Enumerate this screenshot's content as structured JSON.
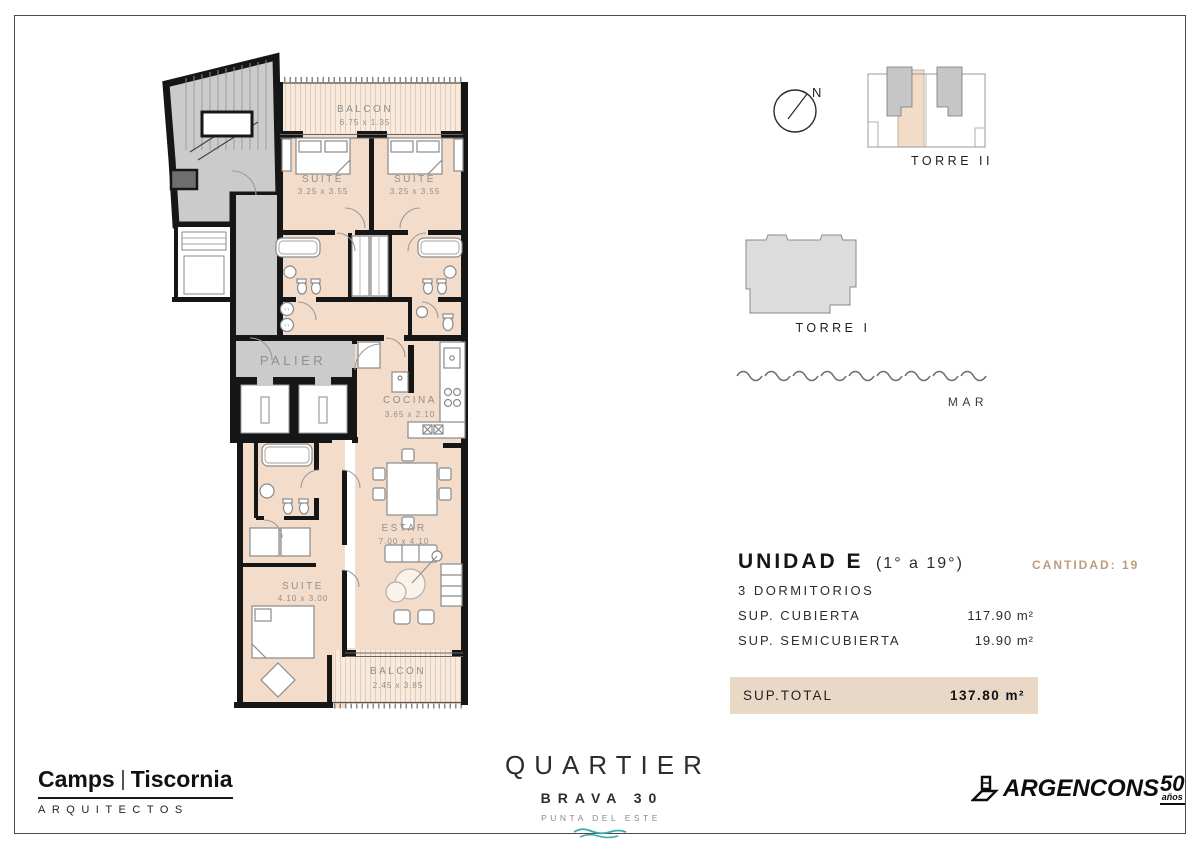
{
  "colors": {
    "accent_tan": "#bf9c79",
    "total_bar_bg": "#e9d8c6",
    "brand_teal": "#3aaca4",
    "room_beige": "#f3dcc9",
    "balcony_beige": "#f8ebdd",
    "common_gray": "#cbcbcb",
    "wall_black": "#161616"
  },
  "plan": {
    "balcon_top": {
      "name": "BALCON",
      "dims": "6.75 x 1.35"
    },
    "suite_1": {
      "name": "SUITE",
      "dims": "3.25 x 3.55"
    },
    "suite_2": {
      "name": "SUITE",
      "dims": "3.25 x 3.55"
    },
    "palier": {
      "name": "PALIER"
    },
    "cocina": {
      "name": "COCINA",
      "dims": "3.65 x 2.10"
    },
    "estar": {
      "name": "ESTAR",
      "dims": "7.00 x 4.10"
    },
    "suite_3": {
      "name": "SUITE",
      "dims": "4.10 x 3.00"
    },
    "balcon_bottom": {
      "name": "BALCON",
      "dims": "2.45 x 3.85"
    },
    "laundry_label": "TT"
  },
  "sitemap": {
    "north_label": "N",
    "torre_ii_label": "TORRE II",
    "torre_i_label": "TORRE I",
    "sea_label": "MAR"
  },
  "unit": {
    "title": "UNIDAD E",
    "floors": "(1° a 19°)",
    "quantity_label": "CANTIDAD: 19",
    "bedrooms": "3 DORMITORIOS",
    "areas": [
      {
        "label": "SUP. CUBIERTA",
        "value": "117.90 m²"
      },
      {
        "label": "SUP. SEMICUBIERTA",
        "value": "19.90 m²"
      }
    ],
    "total": {
      "label": "SUP.TOTAL",
      "value": "137.80 m²"
    }
  },
  "footer": {
    "architects": {
      "name_left": "Camps",
      "name_right": "Tiscornia",
      "subtitle": "ARQUITECTOS"
    },
    "brand": {
      "name": "QUARTIER",
      "line": "BRAVA 30",
      "location": "PUNTA DEL ESTE"
    },
    "developer": {
      "name": "ARGENCONS",
      "years": "50",
      "years_suffix": "años"
    }
  }
}
